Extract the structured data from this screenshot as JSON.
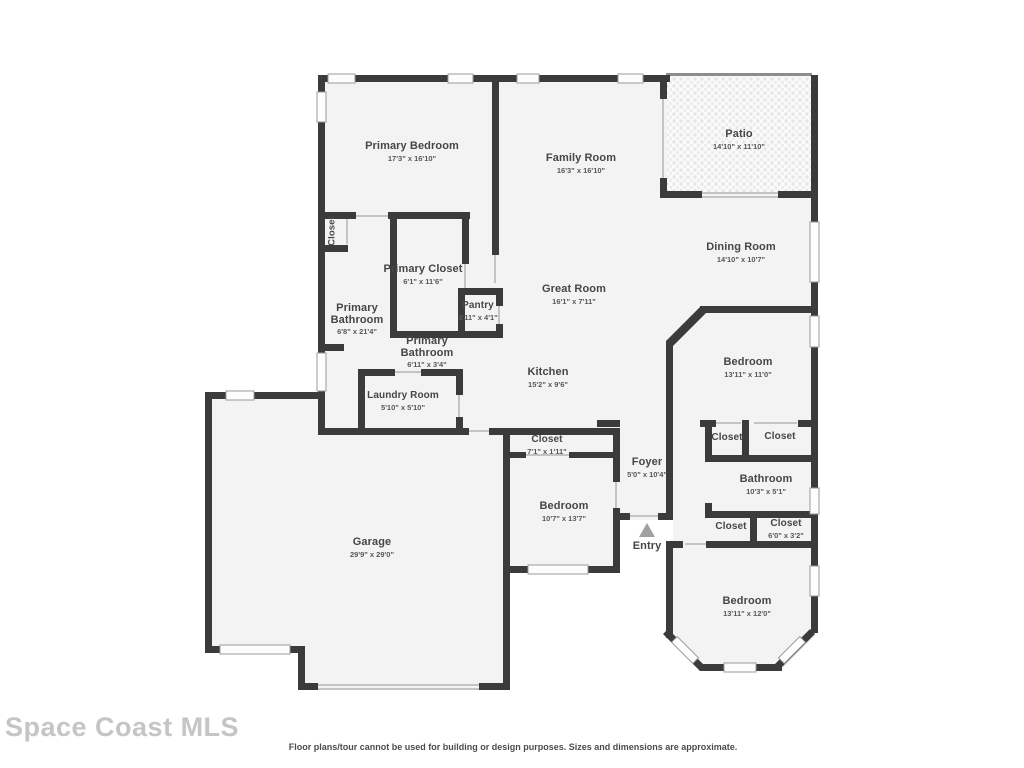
{
  "watermark": {
    "text": "Space Coast MLS"
  },
  "footer": {
    "disclaimer": "Floor plans/tour cannot be used for building or design purposes. Sizes and dimensions are approximate."
  },
  "colors": {
    "wall": "#3b3b3b",
    "room_fill": "#f3f3f3",
    "opening_line": "#c4c4c4",
    "window_fill": "#fdfdfd",
    "label_text": "#464646",
    "watermark_gray": "#c5c5c5",
    "entry_arrow": "#a0a0a0"
  },
  "rooms": [
    {
      "name": "Primary Bedroom",
      "dims": "17'3\" x 16'10\""
    },
    {
      "name": "Family Room",
      "dims": "16'3\" x 16'10\""
    },
    {
      "name": "Patio",
      "dims": "14'10\" x 11'10\""
    },
    {
      "name": "Dining Room",
      "dims": "14'10\" x 10'7\""
    },
    {
      "name": "Great Room",
      "dims": "16'1\" x 7'11\""
    },
    {
      "name": "Kitchen",
      "dims": "15'2\" x 9'6\""
    },
    {
      "name": "Closet",
      "dims": ""
    },
    {
      "name": "Primary Closet",
      "dims": "6'1\" x 11'6\""
    },
    {
      "name": "Primary Bathroom",
      "dims": "6'8\" x 21'4\""
    },
    {
      "name": "Pantry",
      "dims": "3'11\" x 4'1\""
    },
    {
      "name": "Primary Bathroom",
      "dims": "6'11\" x 3'4\""
    },
    {
      "name": "Laundry Room",
      "dims": "5'10\" x 5'10\""
    },
    {
      "name": "Closet",
      "dims": "7'1\" x 1'11\""
    },
    {
      "name": "Bedroom",
      "dims": "10'7\" x 13'7\""
    },
    {
      "name": "Foyer",
      "dims": "5'0\" x 10'4\""
    },
    {
      "name": "Entry",
      "dims": ""
    },
    {
      "name": "Garage",
      "dims": "29'9\" x 29'0\""
    },
    {
      "name": "Bedroom",
      "dims": "13'11\" x 11'0\""
    },
    {
      "name": "Closet",
      "dims": ""
    },
    {
      "name": "Closet",
      "dims": ""
    },
    {
      "name": "Bathroom",
      "dims": "10'3\" x 5'1\""
    },
    {
      "name": "Closet",
      "dims": ""
    },
    {
      "name": "Closet",
      "dims": "6'0\" x 3'2\""
    },
    {
      "name": "Bedroom",
      "dims": "13'11\" x 12'0\""
    }
  ]
}
